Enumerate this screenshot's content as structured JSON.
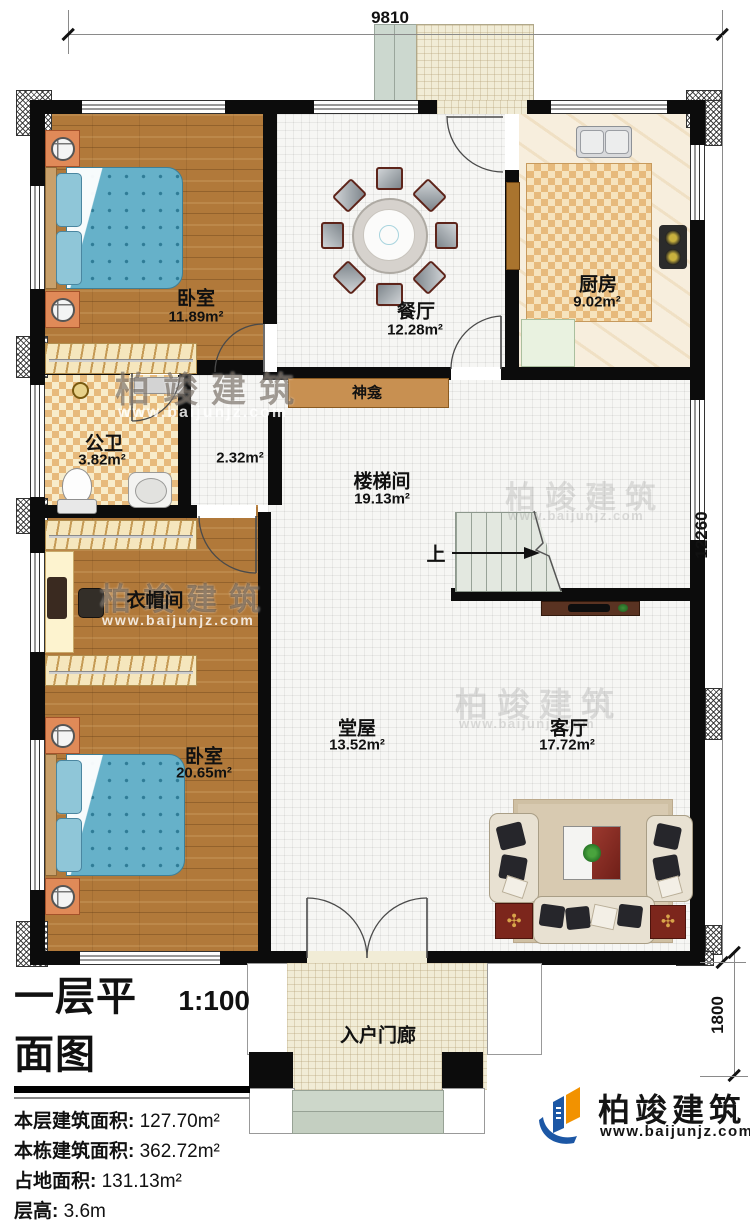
{
  "dimensions": {
    "top": "9810",
    "right": "12260",
    "bottom_right": "1800"
  },
  "rooms": {
    "bedroom1": {
      "name": "卧室",
      "area": "11.89m²"
    },
    "dining": {
      "name": "餐厅",
      "area": "12.28m²"
    },
    "kitchen": {
      "name": "厨房",
      "area": "9.02m²"
    },
    "bathroom": {
      "name": "公卫",
      "area": "3.82m²"
    },
    "corridor": {
      "area": "2.32m²"
    },
    "shrine": {
      "name": "神龛"
    },
    "stairwell": {
      "name": "楼梯间",
      "area": "19.13m²"
    },
    "cloakroom": {
      "name": "衣帽间"
    },
    "bedroom2": {
      "name": "卧室",
      "area": "20.65m²"
    },
    "hall": {
      "name": "堂屋",
      "area": "13.52m²"
    },
    "living": {
      "name": "客厅",
      "area": "17.72m²"
    },
    "porch": {
      "name": "入户门廊"
    }
  },
  "stairs": {
    "up_label": "上"
  },
  "title_block": {
    "title": "一层平面图",
    "scale": "1:100",
    "rows": [
      {
        "label": "本层建筑面积:",
        "value": "127.70m²"
      },
      {
        "label": "本栋建筑面积:",
        "value": "362.72m²"
      },
      {
        "label": "占地面积:",
        "value": "131.13m²"
      },
      {
        "label": "层高:",
        "value": "3.6m"
      }
    ]
  },
  "branding": {
    "name": "柏竣建筑",
    "url": "www.baijunjz.com"
  },
  "watermark": {
    "text": "柏竣建筑",
    "url": "www.baijunjz.com"
  },
  "colors": {
    "accent_blue": "#1c57a5",
    "accent_orange": "#f29200",
    "wall": "#0c0c0c",
    "wood": "#b1793a"
  }
}
